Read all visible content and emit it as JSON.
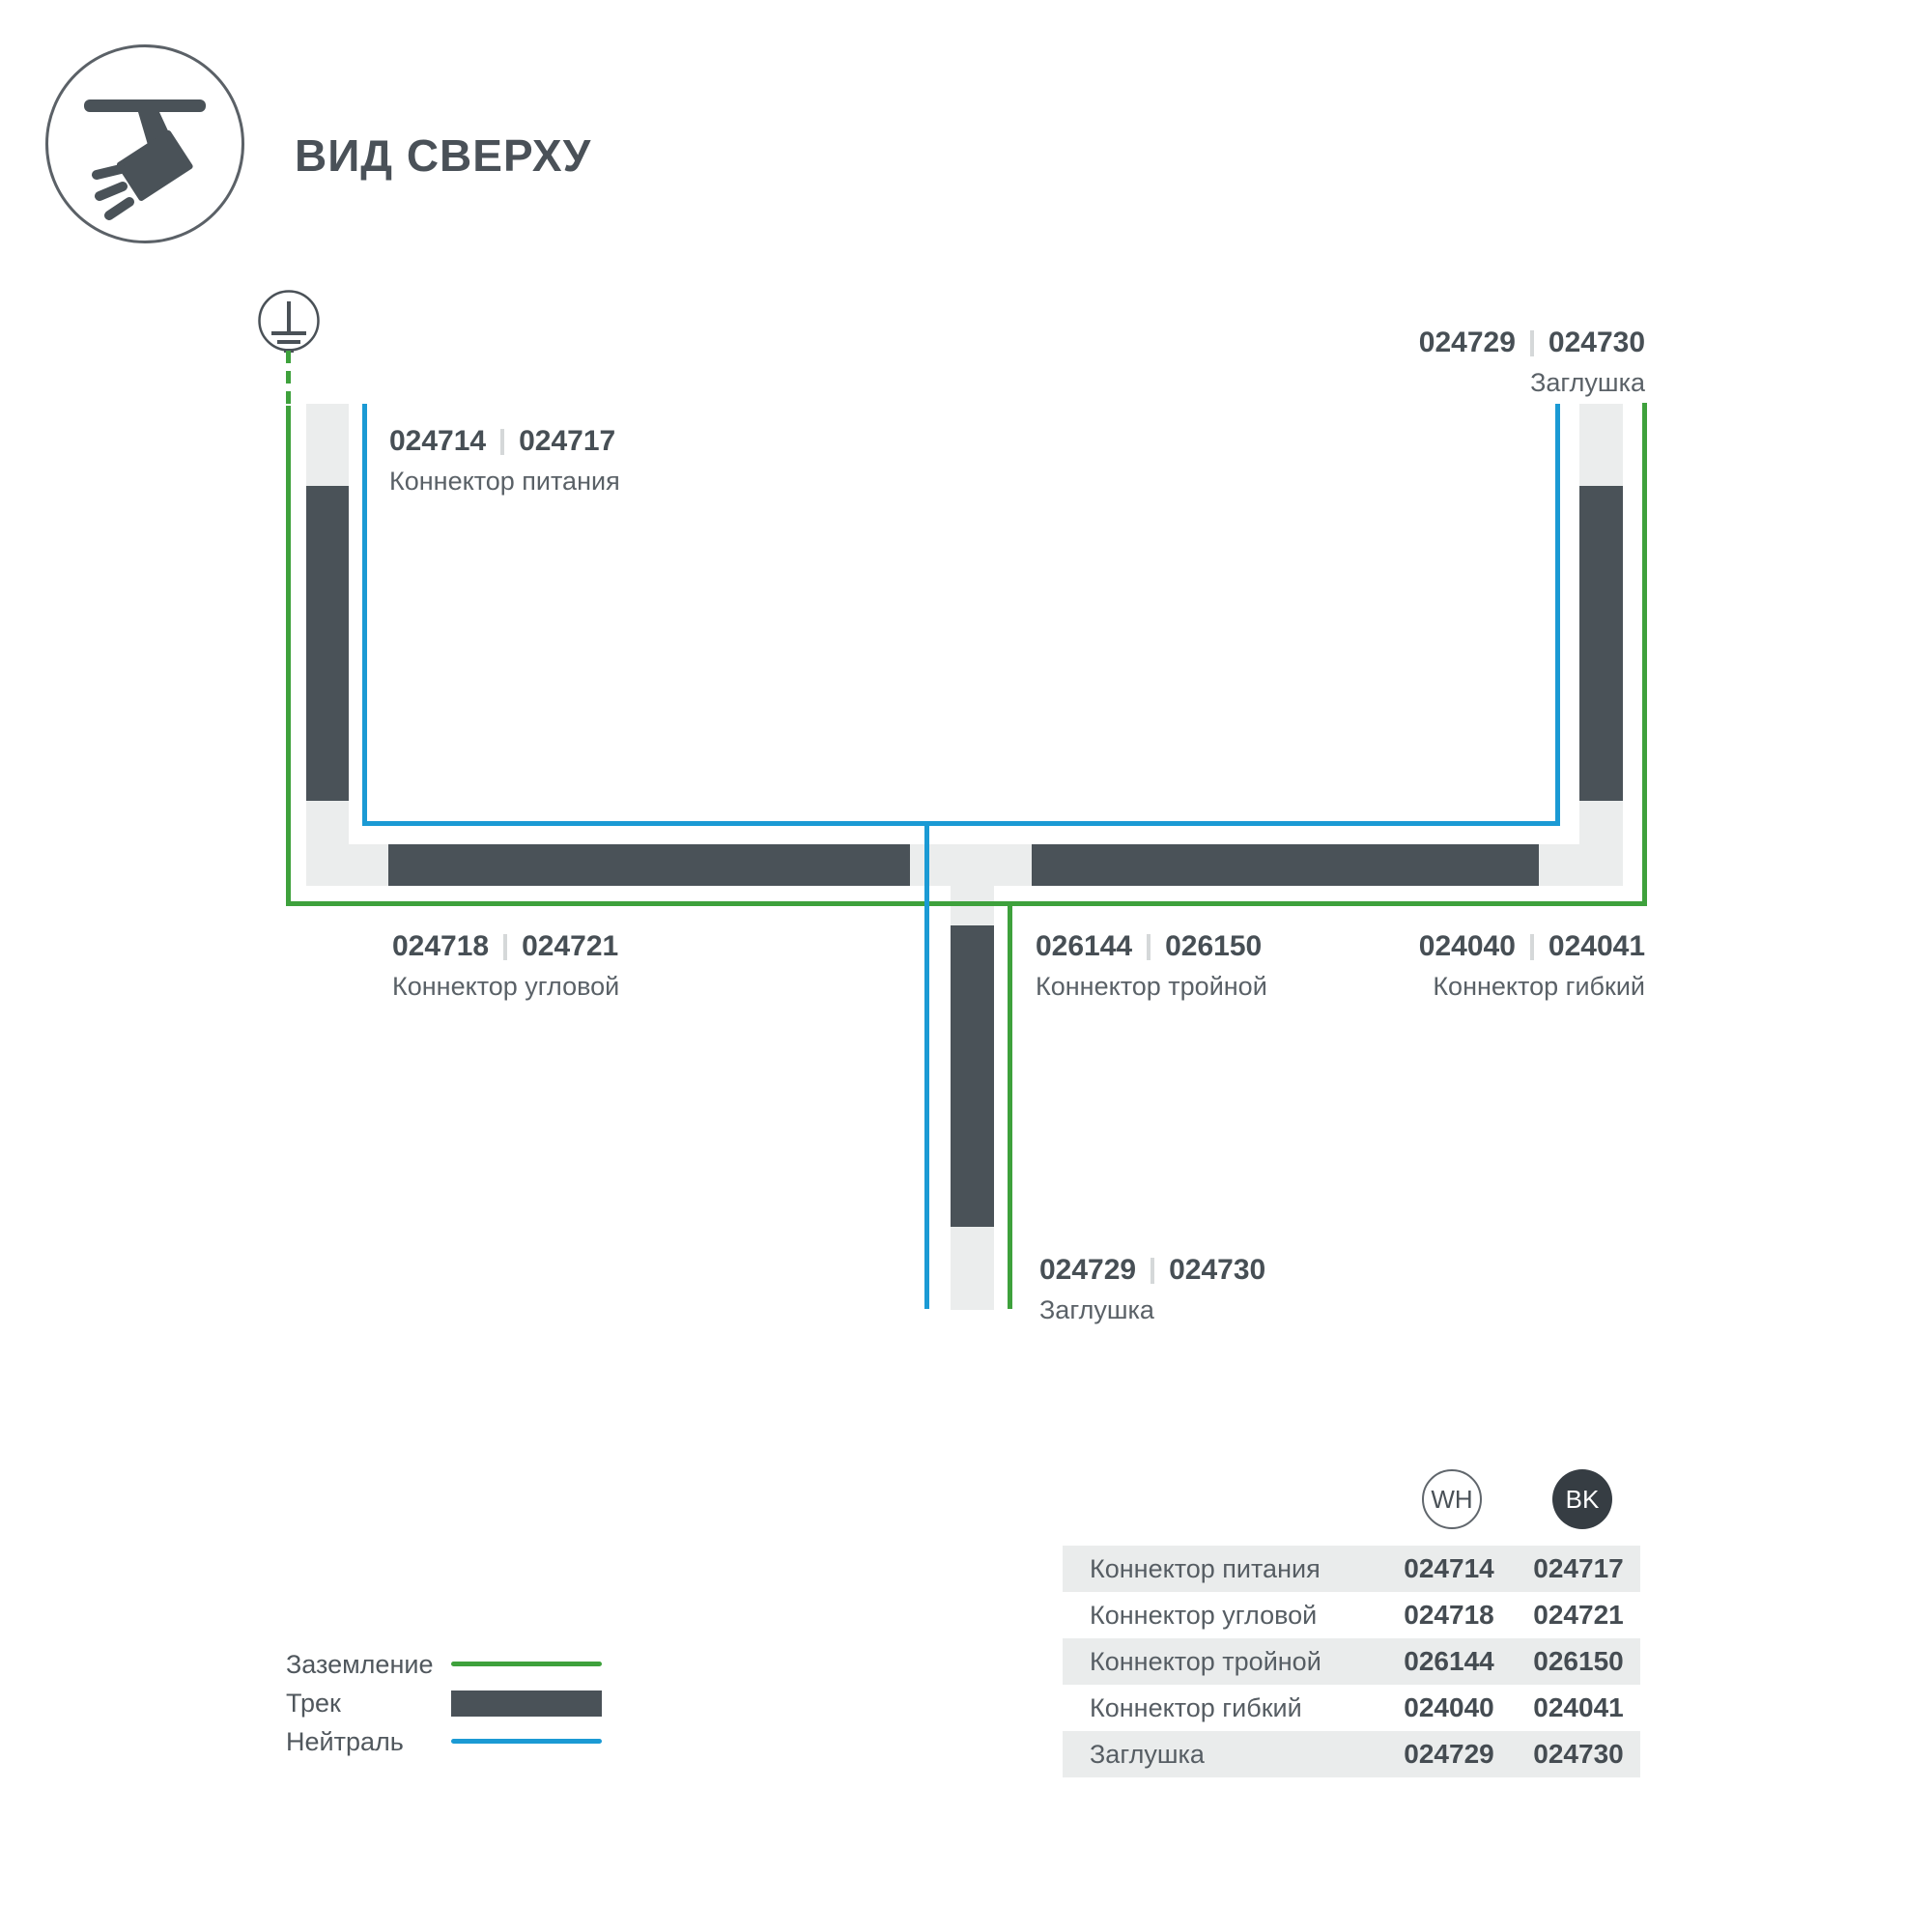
{
  "header": {
    "title": "ВИД СВЕРХУ"
  },
  "icons": {
    "track_light": "track-spotlight-icon",
    "ground": "ground-earth-icon"
  },
  "colors": {
    "track_dark": "#4a5258",
    "track_light": "#ebeded",
    "ground_green": "#3ea13c",
    "neutral_blue": "#1b9ad4",
    "text_dark": "#474f55",
    "text_gray": "#5a6167",
    "bk_circle": "#363d43"
  },
  "diagram": {
    "labels": [
      {
        "code_wh": "024714",
        "code_bk": "024717",
        "name": "Коннектор питания"
      },
      {
        "code_wh": "024729",
        "code_bk": "024730",
        "name": "Заглушка"
      },
      {
        "code_wh": "024718",
        "code_bk": "024721",
        "name": "Коннектор угловой"
      },
      {
        "code_wh": "026144",
        "code_bk": "026150",
        "name": "Коннектор тройной"
      },
      {
        "code_wh": "024040",
        "code_bk": "024041",
        "name": "Коннектор гибкий"
      },
      {
        "code_wh": "024729",
        "code_bk": "024730",
        "name": "Заглушка"
      }
    ]
  },
  "legend": {
    "items": [
      {
        "label": "Заземление",
        "type": "ground-wire"
      },
      {
        "label": "Трек",
        "type": "track"
      },
      {
        "label": "Нейтраль",
        "type": "neutral-wire"
      }
    ]
  },
  "table": {
    "col_wh": "WH",
    "col_bk": "BK",
    "rows": [
      {
        "name": "Коннектор питания",
        "wh": "024714",
        "bk": "024717"
      },
      {
        "name": "Коннектор угловой",
        "wh": "024718",
        "bk": "024721"
      },
      {
        "name": "Коннектор тройной",
        "wh": "026144",
        "bk": "026150"
      },
      {
        "name": "Коннектор гибкий",
        "wh": "024040",
        "bk": "024041"
      },
      {
        "name": "Заглушка",
        "wh": "024729",
        "bk": "024730"
      }
    ]
  }
}
